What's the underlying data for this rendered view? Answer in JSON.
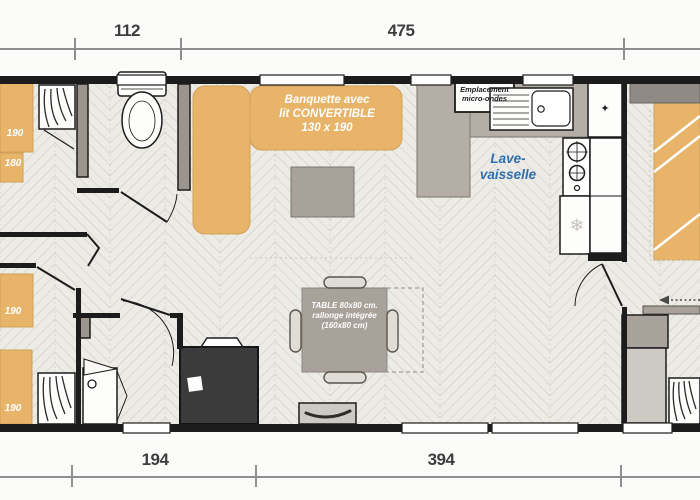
{
  "dimensions": {
    "top": [
      {
        "value": "112"
      },
      {
        "value": "475"
      }
    ],
    "bottom": [
      {
        "value": "194"
      },
      {
        "value": "394"
      }
    ]
  },
  "labels": {
    "sofa": {
      "line1": "Banquette avec",
      "line2": "lit CONVERTIBLE",
      "line3": "130 x 190"
    },
    "microwave": {
      "line1": "Emplacement",
      "line2": "micro-ondes"
    },
    "dishwasher": {
      "line1": "Lave-",
      "line2": "vaisselle"
    },
    "table": {
      "line1": "TABLE 80x80 cm.",
      "line2": "rallonge intégrée",
      "line3": "(160x80 cm)"
    },
    "bed_top_left": "190",
    "shelf_top_left": "180",
    "bed_mid_left": "190",
    "bed_bottom_left": "190"
  },
  "icons": {
    "snowflake": "❄",
    "sparkle": "✦"
  },
  "colors": {
    "wall": "#1c1c1c",
    "furniture_tan": "#e7b469",
    "wall_gray": "#9b958d",
    "furniture_gray": "#a8a29a",
    "dark_unit": "#3b3b3b",
    "dishwasher_text": "#2f6fad",
    "floor": "#edebe6"
  }
}
